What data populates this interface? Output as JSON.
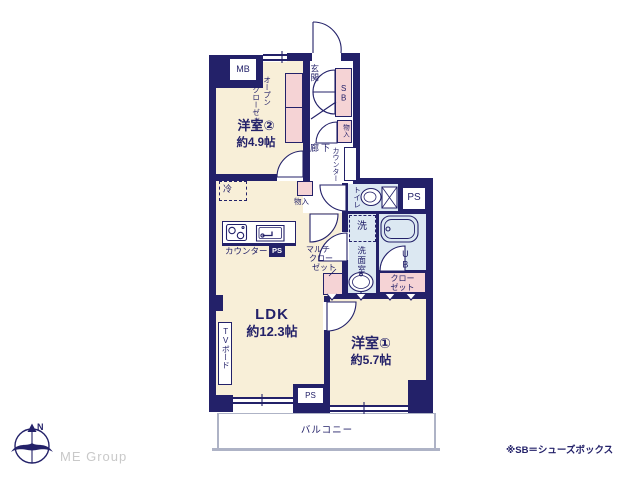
{
  "colors": {
    "navy": "#232169",
    "cream": "#f8efd8",
    "pink": "#f5d3d5",
    "blue": "#dce8f2",
    "white": "#ffffff",
    "logo_gray": "#c9c9c9",
    "balcony_gray": "#aeb3c6"
  },
  "plan": {
    "rooms": {
      "yoshitsu2": {
        "name": "洋室②",
        "size": "約4.9帖"
      },
      "ldk": {
        "name": "LDK",
        "size": "約12.3帖"
      },
      "yoshitsu1": {
        "name": "洋室①",
        "size": "約5.7帖"
      }
    },
    "labels": {
      "mb": "MB",
      "ps": "PS",
      "sb": "SB",
      "ub": "UB",
      "genkan": "玄関",
      "rouka": "廊下",
      "toilet": "トイレ",
      "washroom": "洗面室",
      "washer": "洗",
      "fridge": "冷",
      "monoire": "物入",
      "counter": "カウンター",
      "tv_board": "TVボード",
      "balcony": "バルコニー",
      "open_closet_1": "オープン",
      "open_closet_2": "クローゼット",
      "multi_closet_1": "マルチ",
      "multi_closet_2": "クロー",
      "multi_closet_3": "ゼット",
      "closet_1": "クロー",
      "closet_2": "ゼット"
    }
  },
  "footer": {
    "compass_label": "N",
    "logo_text": "ME Group",
    "note": "※SB＝シューズボックス"
  }
}
